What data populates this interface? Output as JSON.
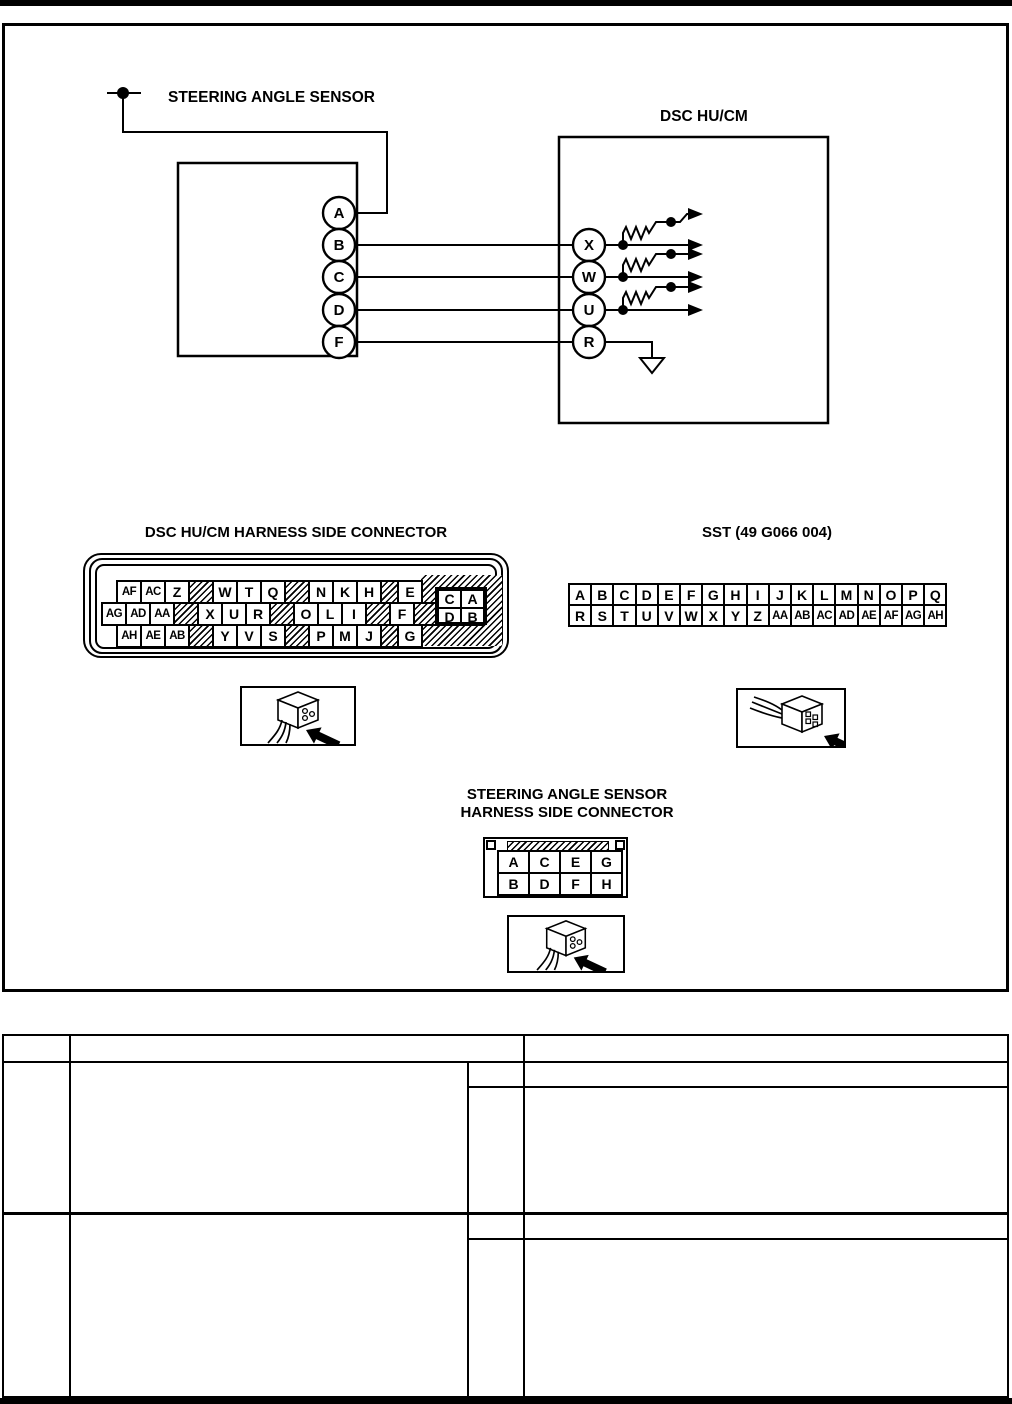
{
  "page": {
    "background": "#ffffff",
    "ink": "#000000"
  },
  "wiring_diagram": {
    "sensor_label": "STEERING ANGLE SENSOR",
    "dsc_label": "DSC HU/CM",
    "sensor_pins": [
      "A",
      "B",
      "C",
      "D",
      "F"
    ],
    "dsc_pins": [
      "X",
      "W",
      "U",
      "R"
    ]
  },
  "dsc_harness_connector": {
    "title": "DSC HU/CM HARNESS SIDE CONNECTOR",
    "rows": [
      [
        "AF",
        "AC",
        "Z",
        "#",
        "W",
        "T",
        "Q",
        "#",
        "N",
        "K",
        "H",
        "#s",
        "E"
      ],
      [
        "AG",
        "AD",
        "AA",
        "#",
        "X",
        "U",
        "R",
        "#",
        "O",
        "L",
        "I",
        "#",
        "F",
        "#"
      ],
      [
        "AH",
        "AE",
        "AB",
        "#",
        "Y",
        "V",
        "S",
        "#",
        "P",
        "M",
        "J",
        "#s",
        "G"
      ]
    ],
    "corner_block": [
      [
        "C",
        "A"
      ],
      [
        "D",
        "B"
      ]
    ],
    "icon": "connector-plug-arrow-icon"
  },
  "sst_connector": {
    "title": "SST (49 G066 004)",
    "rows": [
      [
        "A",
        "B",
        "C",
        "D",
        "E",
        "F",
        "G",
        "H",
        "I",
        "J",
        "K",
        "L",
        "M",
        "N",
        "O",
        "P",
        "Q"
      ],
      [
        "R",
        "S",
        "T",
        "U",
        "V",
        "W",
        "X",
        "Y",
        "Z",
        "AA",
        "AB",
        "AC",
        "AD",
        "AE",
        "AF",
        "AG",
        "AH"
      ]
    ],
    "icon": "connector-plug-arrow-icon"
  },
  "sas_connector": {
    "title_line1": "STEERING ANGLE SENSOR",
    "title_line2": "HARNESS SIDE CONNECTOR",
    "rows": [
      [
        "A",
        "C",
        "E",
        "G"
      ],
      [
        "B",
        "D",
        "F",
        "H"
      ]
    ],
    "icon": "connector-plug-arrow-icon"
  },
  "results_table": {
    "header": [
      "",
      "",
      ""
    ],
    "rows": [
      [
        "",
        "",
        "",
        "",
        ""
      ],
      [
        "",
        "",
        "",
        "",
        ""
      ]
    ]
  }
}
